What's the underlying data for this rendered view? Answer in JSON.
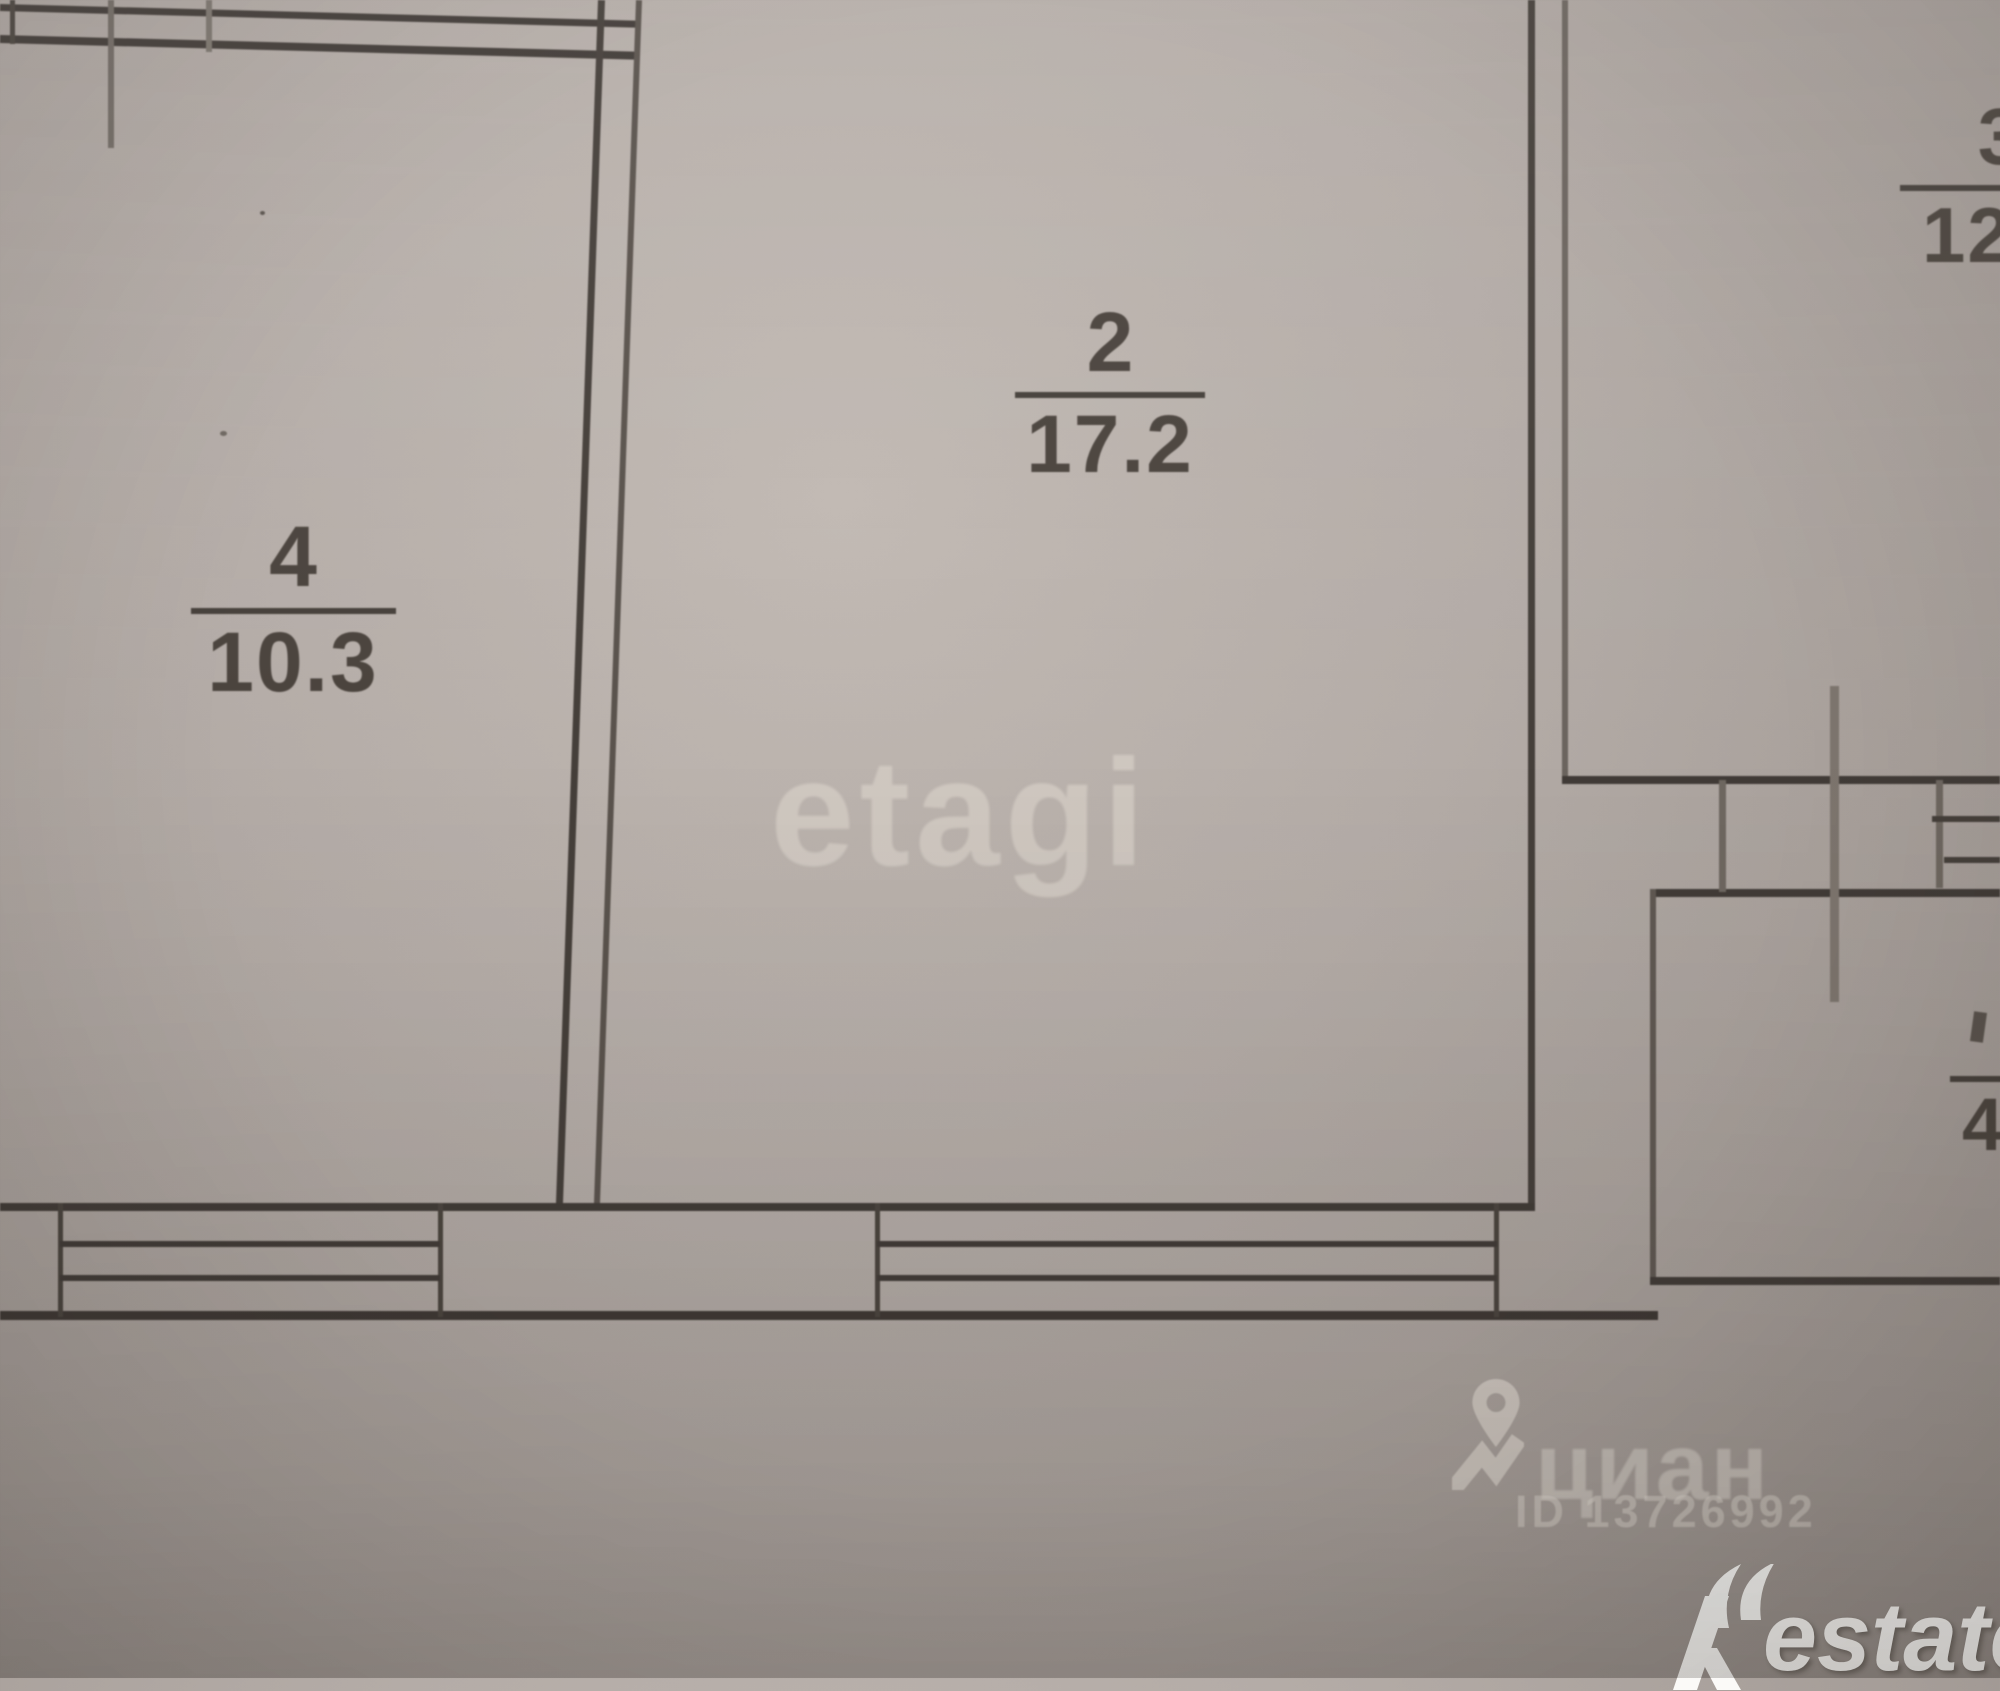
{
  "photo": {
    "kind": "apartment floor plan photo"
  },
  "rooms": [
    {
      "number": "4",
      "area": "10.3"
    },
    {
      "number": "2",
      "area": "17.2"
    },
    {
      "number": "3",
      "area": "12"
    },
    {
      "number": "",
      "area": "4"
    }
  ],
  "watermarks": {
    "etagi_text": "etagi",
    "cian_text": "циан",
    "cian_id": "ID 13726992",
    "restate_brand": "Restate",
    "restate_text_part": "estate"
  },
  "colors": {
    "paper": "#b4aca7",
    "ink": "#413b37",
    "ink_light": "#6e6760",
    "label_ink": "#4b443e",
    "watermark_light": "rgba(226,219,212,0.55)",
    "watermark_white": "#fbfaf8"
  }
}
